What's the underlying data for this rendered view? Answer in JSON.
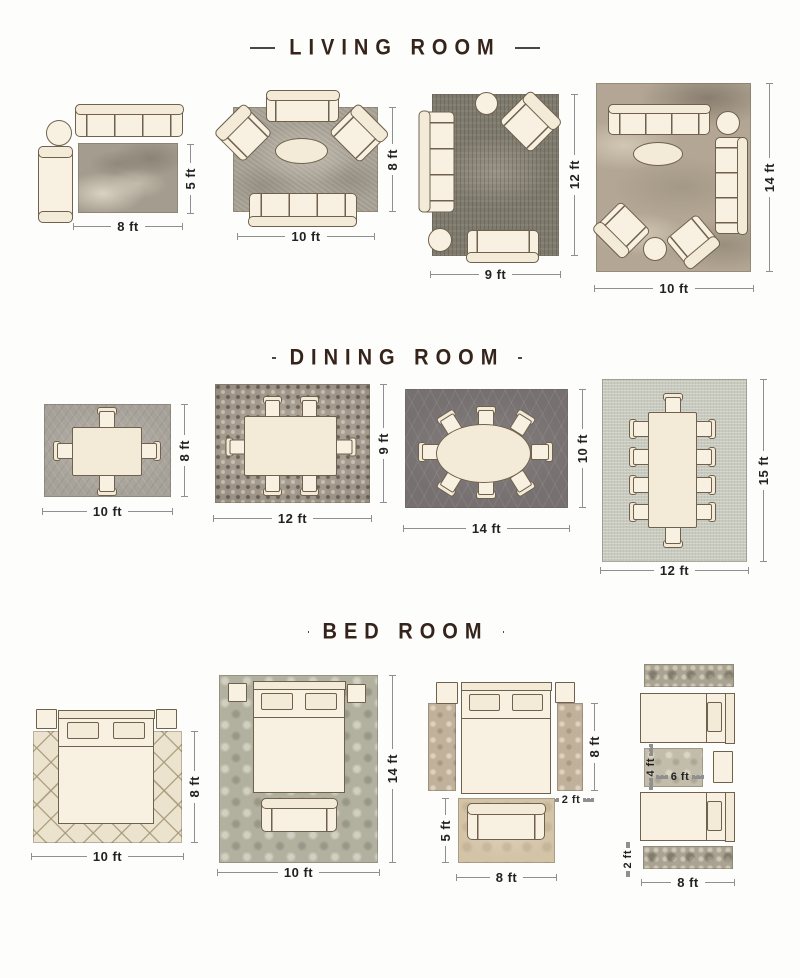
{
  "palette": {
    "background": "#fdfdfc",
    "heading_text": "#35241b",
    "dimension_text": "#222222",
    "dimension_line": "#8f8f8f",
    "furniture_fill": "#f8f1e1",
    "furniture_outline": "#6f614d",
    "rugs": {
      "living_1": "#a49d8f",
      "living_2": "#a8a296",
      "living_3": "#7f7a6e",
      "living_4": "#b3a694",
      "dining_1": "#a6a29a",
      "dining_2": "#93897d",
      "dining_3": "#767071",
      "dining_4": "#c8cabf",
      "bedroom_trellis": "#ece3cf",
      "bedroom_damask": "#b2b1a0",
      "bedroom_runner": "#c1b19a",
      "bedroom_foot_rug": "#d3c3a7",
      "bedroom_twin_runner": "#aaa391",
      "bedroom_between_rug": "#c2bcaa"
    }
  },
  "sections": [
    {
      "title": "LIVING ROOM",
      "layouts": [
        {
          "name": "5x8 rug",
          "width_label": "8 ft",
          "height_label": "5 ft"
        },
        {
          "name": "8x10 rug",
          "width_label": "10 ft",
          "height_label": "8 ft"
        },
        {
          "name": "9x12 rug",
          "width_label": "9 ft",
          "height_label": "12 ft"
        },
        {
          "name": "10x14 rug",
          "width_label": "10 ft",
          "height_label": "14 ft"
        }
      ]
    },
    {
      "title": "DINING ROOM",
      "layouts": [
        {
          "name": "8x10 rug",
          "width_label": "10 ft",
          "height_label": "8 ft",
          "chairs": 4
        },
        {
          "name": "9x12 rug",
          "width_label": "12 ft",
          "height_label": "9 ft",
          "chairs": 6
        },
        {
          "name": "10x14 rug",
          "width_label": "14 ft",
          "height_label": "10 ft",
          "chairs": 8
        },
        {
          "name": "12x15 rug",
          "width_label": "12 ft",
          "height_label": "15 ft",
          "chairs": 10
        }
      ]
    },
    {
      "title": "BED ROOM",
      "layouts": [
        {
          "name": "8x10 rug",
          "width_label": "10 ft",
          "height_label": "8 ft"
        },
        {
          "name": "10x14 rug",
          "width_label": "10 ft",
          "height_label": "14 ft"
        },
        {
          "name": "side runners + foot rug",
          "runner_length_label": "8 ft",
          "runner_width_label": "2 ft",
          "foot_rug_height_label": "5 ft",
          "foot_rug_width_label": "8 ft"
        },
        {
          "name": "twin beds + runners",
          "between_rug_height_label": "4 ft",
          "between_rug_width_label": "6 ft",
          "runner_width_label": "2 ft",
          "runner_length_label": "8 ft"
        }
      ]
    }
  ]
}
